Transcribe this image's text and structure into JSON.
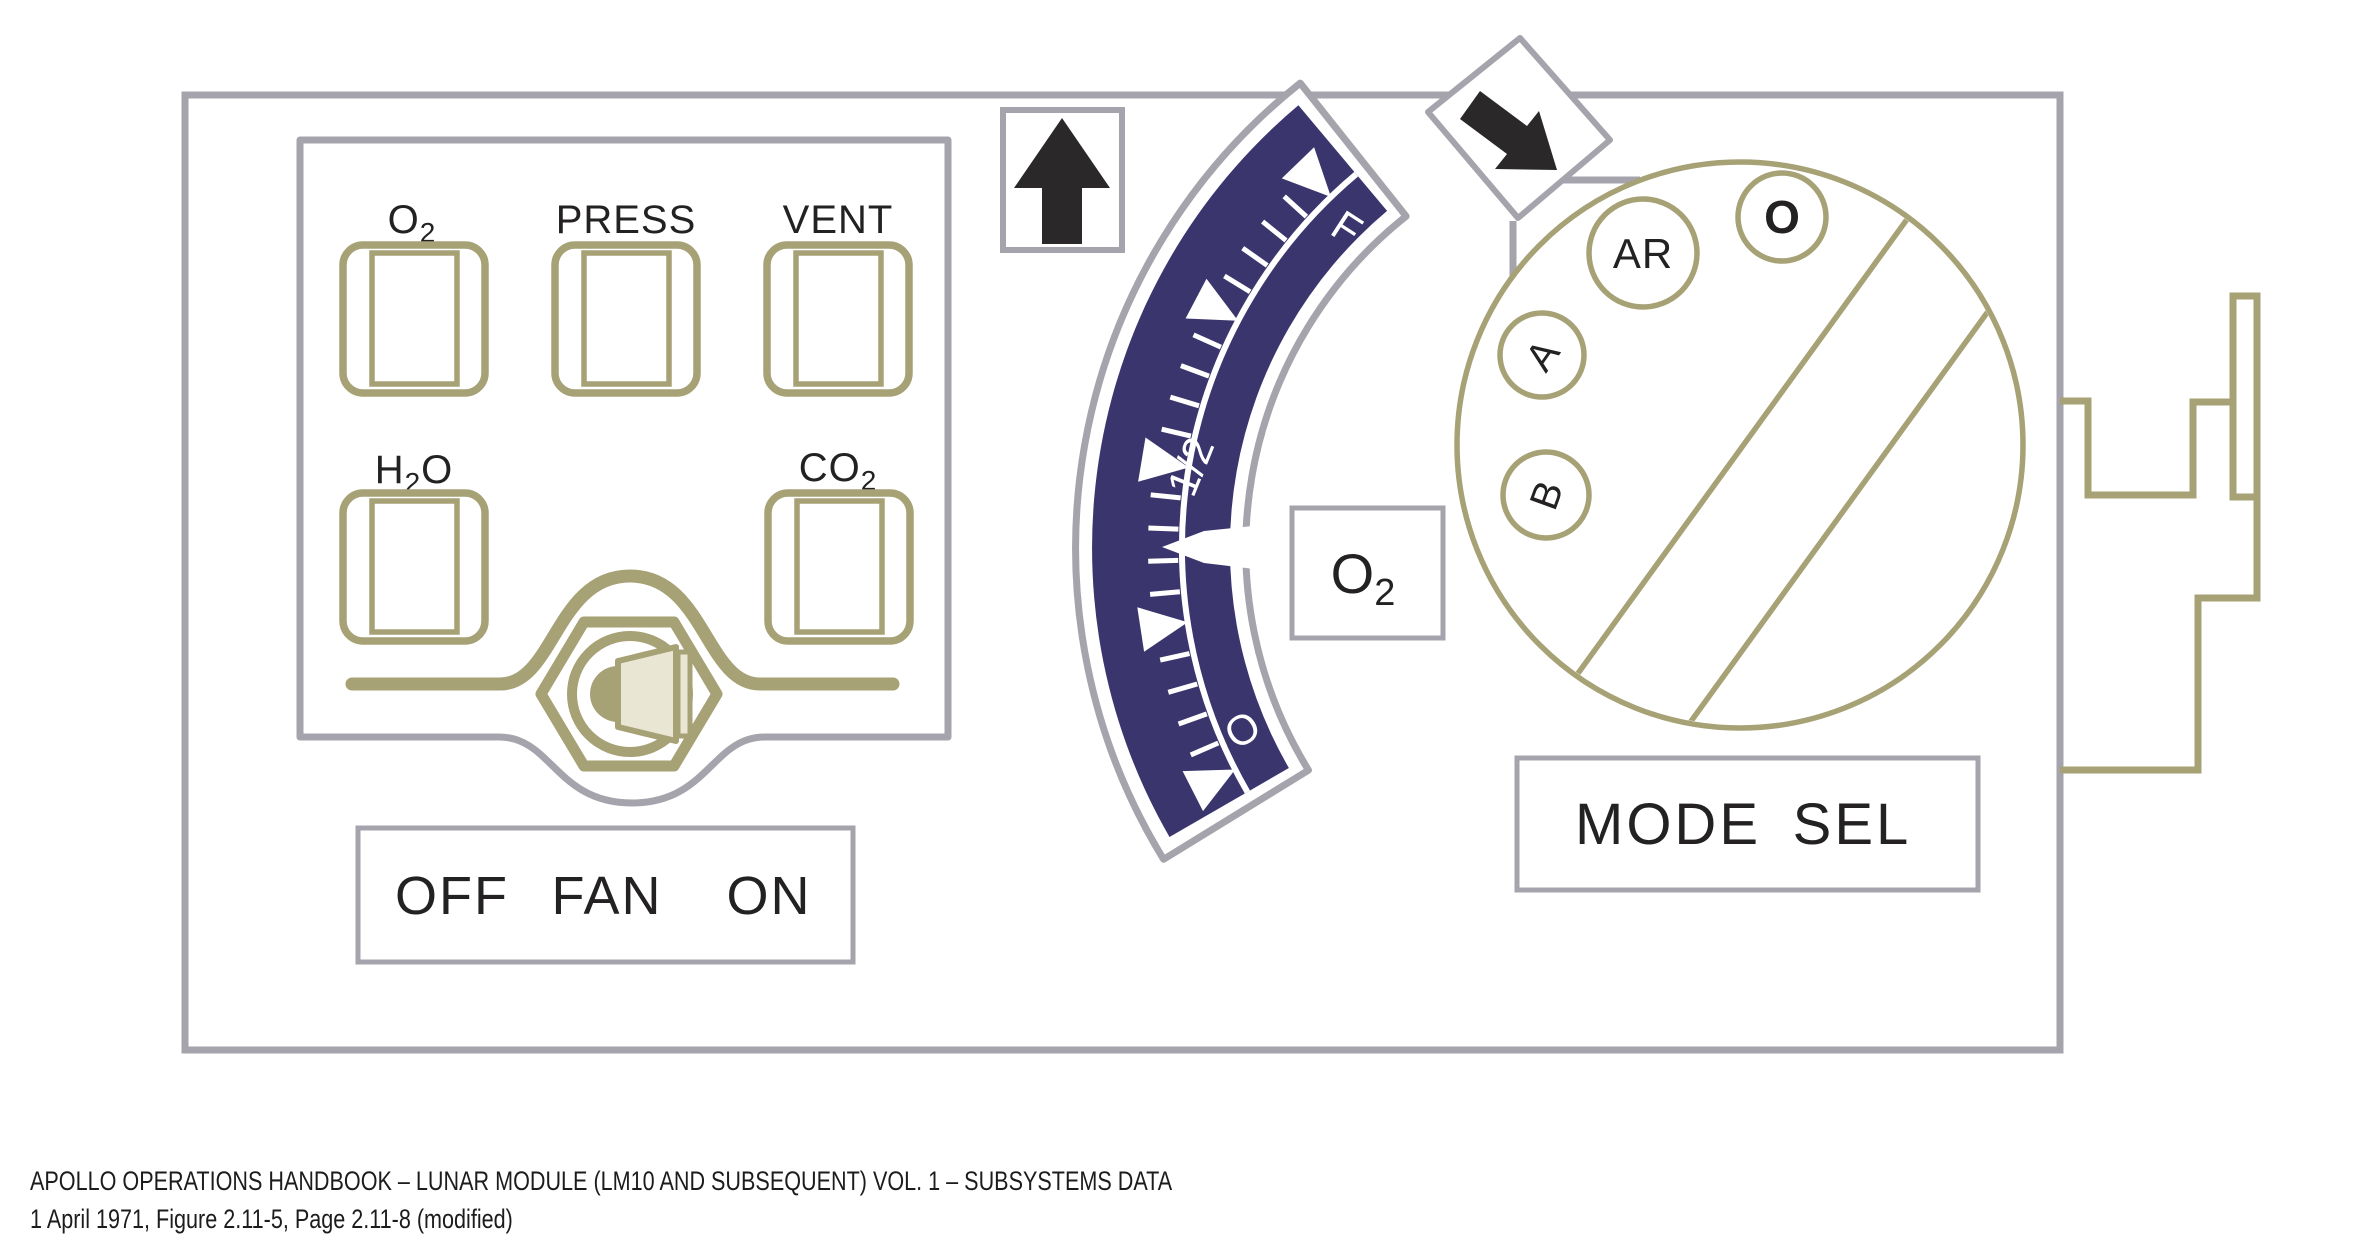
{
  "figure": {
    "caption_line1": "APOLLO OPERATIONS HANDBOOK – LUNAR MODULE (LM10 AND SUBSEQUENT) VOL. 1 – SUBSYSTEMS DATA",
    "caption_line2": "1 April 1971, Figure 2.11-5, Page 2.11-8 (modified)"
  },
  "colors": {
    "panel_gray": "#a5a4ac",
    "olive": "#a7a176",
    "navy": "#3b356e",
    "beige": "#e9e6d3",
    "ink": "#232122"
  },
  "indicator_panel": {
    "indicators": [
      {
        "id": "o2",
        "pre": "O",
        "sub": "2",
        "post": ""
      },
      {
        "id": "press",
        "pre": "PRESS",
        "sub": "",
        "post": ""
      },
      {
        "id": "vent",
        "pre": "VENT",
        "sub": "",
        "post": ""
      },
      {
        "id": "h2o",
        "pre": "H",
        "sub": "2",
        "post": "O"
      },
      {
        "id": "co2",
        "pre": "CO",
        "sub": "2",
        "post": ""
      }
    ],
    "fan_switch": {
      "off": "OFF",
      "fan": "FAN",
      "on": "ON"
    }
  },
  "gauge": {
    "scale_labels": {
      "full": "F",
      "half": "1/2",
      "empty": "O"
    },
    "parameter": {
      "pre": "O",
      "sub": "2"
    }
  },
  "mode_selector": {
    "positions": {
      "ar": "AR",
      "o": "O",
      "a": "A",
      "b": "B"
    },
    "label": {
      "word1": "MODE",
      "word2": "SEL"
    }
  }
}
